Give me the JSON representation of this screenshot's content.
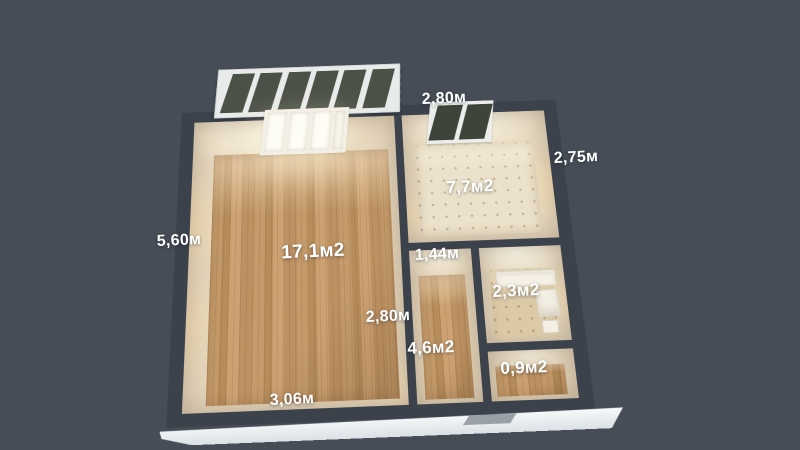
{
  "rooms": [
    {
      "id": "living-room",
      "area_label": "17,1м2"
    },
    {
      "id": "kitchen",
      "area_label": "7,7м2"
    },
    {
      "id": "hallway",
      "area_label": "4,6м2"
    },
    {
      "id": "bathroom",
      "area_label": "2,3м2"
    },
    {
      "id": "wc",
      "area_label": "0,9м2"
    }
  ],
  "dimensions": [
    {
      "id": "kitchen-width",
      "label": "2,80м"
    },
    {
      "id": "kitchen-depth",
      "label": "2,75м"
    },
    {
      "id": "left-side-depth",
      "label": "5,60м"
    },
    {
      "id": "bottom-width",
      "label": "3,06м"
    },
    {
      "id": "living-inner-width",
      "label": "2,80м"
    },
    {
      "id": "hallway-width",
      "label": "1,44м"
    }
  ],
  "colors": {
    "background": "#464d56",
    "walls": "#3b424c",
    "wood_floor": "#c19768",
    "kitchen_floor": "#ece2cb",
    "tile_floor": "#dccaa7",
    "slab": "#eef1f3",
    "label_text": "#ffffff"
  }
}
